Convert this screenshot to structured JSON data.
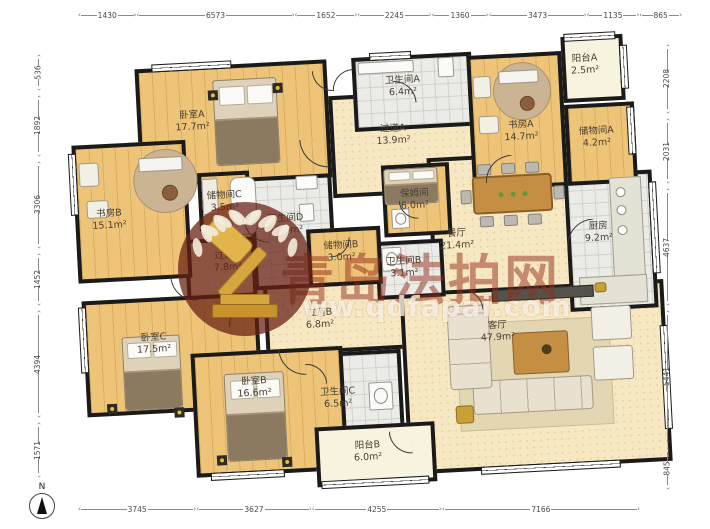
{
  "compass": {
    "label": "N"
  },
  "watermark": {
    "site_name": "青岛法拍网",
    "site_url": "www.qdfapai.com"
  },
  "dimensions": {
    "top": [
      1430,
      6573,
      1652,
      2245,
      1360,
      3473,
      1135,
      865
    ],
    "bottom": [
      3745,
      3627,
      4255,
      7166
    ],
    "left": [
      536,
      1892,
      3306,
      1452,
      4394,
      1571
    ],
    "right": [
      2208,
      2031,
      4637,
      5441,
      845
    ]
  },
  "rooms": [
    {
      "id": "hallway-a",
      "name": "过道A",
      "area": "13.9m²",
      "floor": "hall",
      "rect": [
        287,
        50,
        155,
        102
      ],
      "label": [
        350,
        92
      ]
    },
    {
      "id": "hallway-b",
      "name": "过道B",
      "area": "6.8m²",
      "floor": "hall",
      "rect": [
        212,
        236,
        180,
        70
      ],
      "label": [
        267,
        272
      ]
    },
    {
      "id": "hallway-c",
      "name": "过道C",
      "area": "7.8m²",
      "floor": "hall",
      "rect": [
        136,
        186,
        70,
        84
      ],
      "label": [
        178,
        210
      ]
    },
    {
      "id": "dining-room",
      "name": "餐厅",
      "area": "21.4m²",
      "floor": "hall",
      "rect": [
        382,
        117,
        148,
        150
      ],
      "label": [
        408,
        200
      ]
    },
    {
      "id": "living-room",
      "name": "客厅",
      "area": "47.9m²",
      "floor": "hall",
      "rect": [
        348,
        250,
        264,
        182
      ],
      "label": [
        444,
        294
      ]
    },
    {
      "id": "bathroom-a",
      "name": "卫生间A",
      "area": "6.4m²",
      "floor": "tile",
      "rect": [
        312,
        13,
        120,
        74
      ],
      "label": [
        362,
        44
      ]
    },
    {
      "id": "bathroom-d",
      "name": "卫生间D",
      "area": "11.9m²",
      "floor": "tile",
      "rect": [
        204,
        120,
        82,
        120
      ],
      "label": [
        238,
        176
      ]
    },
    {
      "id": "bathroom-b",
      "name": "卫生间B",
      "area": "3.1m²",
      "floor": "tile",
      "rect": [
        326,
        198,
        68,
        58
      ],
      "label": [
        354,
        225
      ]
    },
    {
      "id": "bathroom-c",
      "name": "卫生间C",
      "area": "6.5m²",
      "floor": "tile",
      "rect": [
        238,
        306,
        108,
        80
      ],
      "label": [
        281,
        352
      ]
    },
    {
      "id": "kitchen",
      "name": "厨房",
      "area": "9.2m²",
      "floor": "tile",
      "rect": [
        518,
        140,
        88,
        138
      ],
      "label": [
        550,
        200
      ]
    },
    {
      "id": "bedroom-a",
      "name": "卧室A",
      "area": "17.7m²",
      "floor": "wood",
      "rect": [
        95,
        13,
        192,
        118
      ],
      "label": [
        150,
        68
      ]
    },
    {
      "id": "study-a",
      "name": "书房A",
      "area": "14.7m²",
      "floor": "wood",
      "rect": [
        427,
        17,
        95,
        135
      ],
      "label": [
        478,
        95
      ]
    },
    {
      "id": "study-b",
      "name": "书房B",
      "area": "15.1m²",
      "floor": "wood",
      "rect": [
        28,
        86,
        114,
        138
      ],
      "label": [
        62,
        162
      ]
    },
    {
      "id": "storage-a",
      "name": "储物间A",
      "area": "4.2m²",
      "floor": "wood",
      "rect": [
        522,
        71,
        70,
        81
      ],
      "label": [
        553,
        105
      ]
    },
    {
      "id": "storage-c",
      "name": "储物间C",
      "area": "3.5m²",
      "floor": "wood",
      "rect": [
        152,
        120,
        52,
        58
      ],
      "label": [
        178,
        150
      ]
    },
    {
      "id": "storage-b",
      "name": "储物间B",
      "area": "3.0m²",
      "floor": "wood",
      "rect": [
        258,
        182,
        74,
        58
      ],
      "label": [
        292,
        206
      ]
    },
    {
      "id": "nanny-room",
      "name": "保姆间",
      "area": "6.0m²",
      "floor": "wood",
      "rect": [
        336,
        122,
        68,
        72
      ],
      "label": [
        368,
        158
      ]
    },
    {
      "id": "bedroom-c",
      "name": "卧室C",
      "area": "17.5m²",
      "floor": "wood",
      "rect": [
        30,
        242,
        176,
        116
      ],
      "label": [
        100,
        288
      ]
    },
    {
      "id": "bedroom-b",
      "name": "卧室B",
      "area": "16.6m²",
      "floor": "wood",
      "rect": [
        136,
        300,
        152,
        124
      ],
      "label": [
        198,
        337
      ]
    },
    {
      "id": "balcony-a",
      "name": "阳台A",
      "area": "2.5m²",
      "floor": "balcony",
      "rect": [
        522,
        3,
        62,
        66
      ],
      "label": [
        545,
        32
      ]
    },
    {
      "id": "balcony-b",
      "name": "阳台B",
      "area": "6.0m²",
      "floor": "balcony",
      "rect": [
        256,
        380,
        120,
        60
      ],
      "label": [
        308,
        407
      ]
    }
  ]
}
